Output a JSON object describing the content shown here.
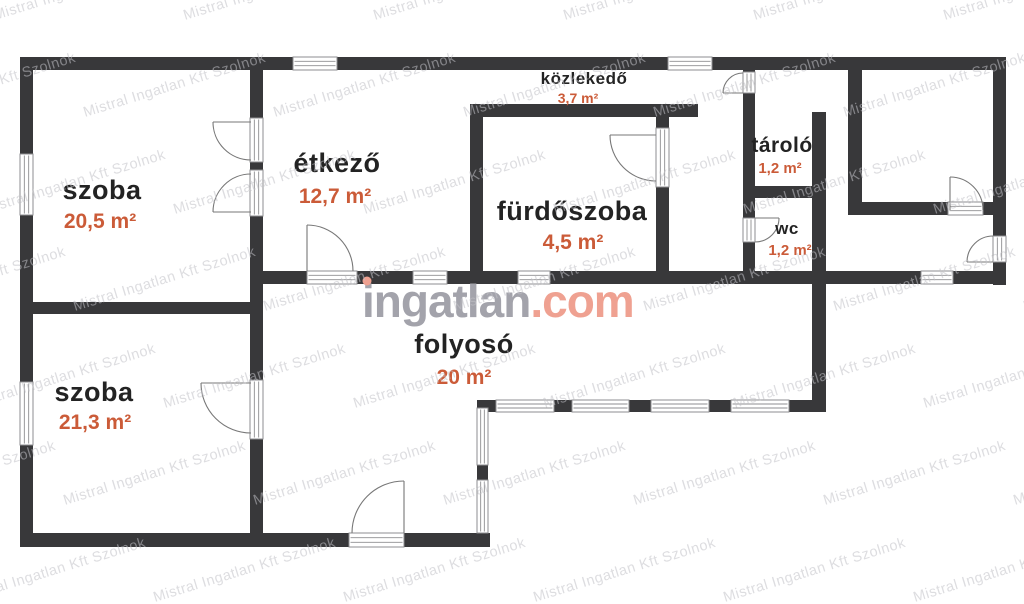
{
  "branding": {
    "logo": {
      "gray_part": "ingatlan",
      "accent_part": ".com"
    },
    "watermark_text": "Mistral Ingatlan Kft Szolnok"
  },
  "colors": {
    "wall": "#38383a",
    "room_label": "#232323",
    "area_label": "#cb5b38",
    "watermark": "#c2c2c8",
    "logo_gray": "#a3a3ab",
    "logo_accent": "#efa191",
    "window_stroke": "#8e8e90",
    "door_stroke": "#777777",
    "background": "#ffffff"
  },
  "rooms": [
    {
      "id": "szoba-top",
      "name": "szoba",
      "area": "20,5 m²"
    },
    {
      "id": "etkezo",
      "name": "étkező",
      "area": "12,7 m²"
    },
    {
      "id": "kozlekedo",
      "name": "közlekedő",
      "area": "3,7 m²"
    },
    {
      "id": "furdoszoba",
      "name": "fürdőszoba",
      "area": "4,5 m²"
    },
    {
      "id": "tarolo",
      "name": "tároló",
      "area": "1,2 m²"
    },
    {
      "id": "wc",
      "name": "wc",
      "area": "1,2 m²"
    },
    {
      "id": "szoba-bottom",
      "name": "szoba",
      "area": "21,3 m²"
    },
    {
      "id": "folyoso",
      "name": "folyosó",
      "area": "20 m²"
    }
  ]
}
